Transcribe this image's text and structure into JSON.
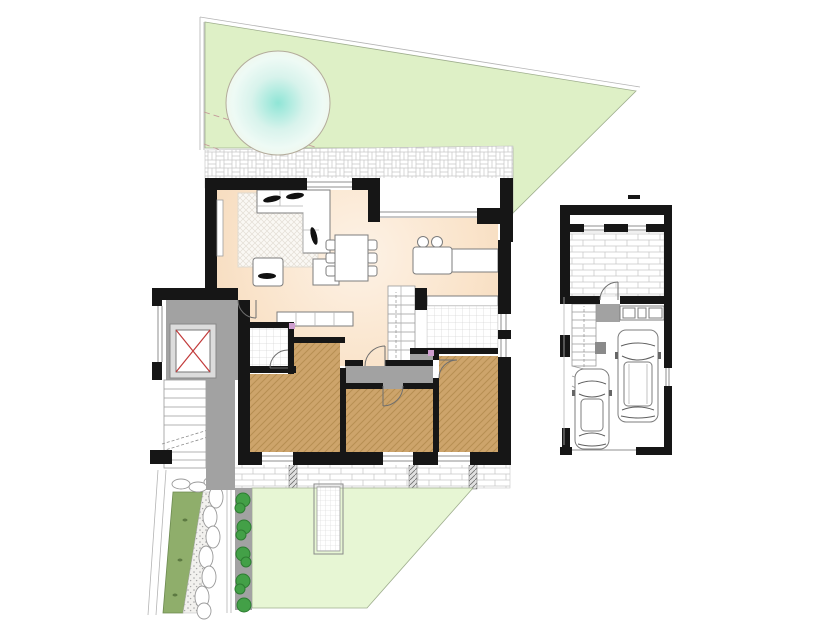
{
  "canvas": {
    "width": 840,
    "height": 630,
    "background": "#ffffff"
  },
  "colors": {
    "wall": "#161616",
    "garden": "#def0c6",
    "lawn": "#e7f6d4",
    "boundary": "#9fae8e",
    "dash": "#c49a9a",
    "paving_line": "#c6c6c6",
    "floor_light": "#fdf2e6",
    "floor_mid": "#fae4cb",
    "floor_deep": "#f3d6b6",
    "bedroom_fill": "#cda46b",
    "bedroom_hatch": "#b78f52",
    "tile_line": "#d6d6d6",
    "gray_floor": "#a2a2a2",
    "gray_dark": "#8f8f8f",
    "tree_teal": "#8fe5d6",
    "shrub": "#43a047",
    "shrub_dark": "#2e7d32",
    "slope": "#8fae6b",
    "gravel_dot": "#a8a8a8",
    "cross_red": "#c23b3b",
    "marker_pink": "#cf9fcf",
    "rock_line": "#9a9a9a",
    "white": "#ffffff"
  }
}
